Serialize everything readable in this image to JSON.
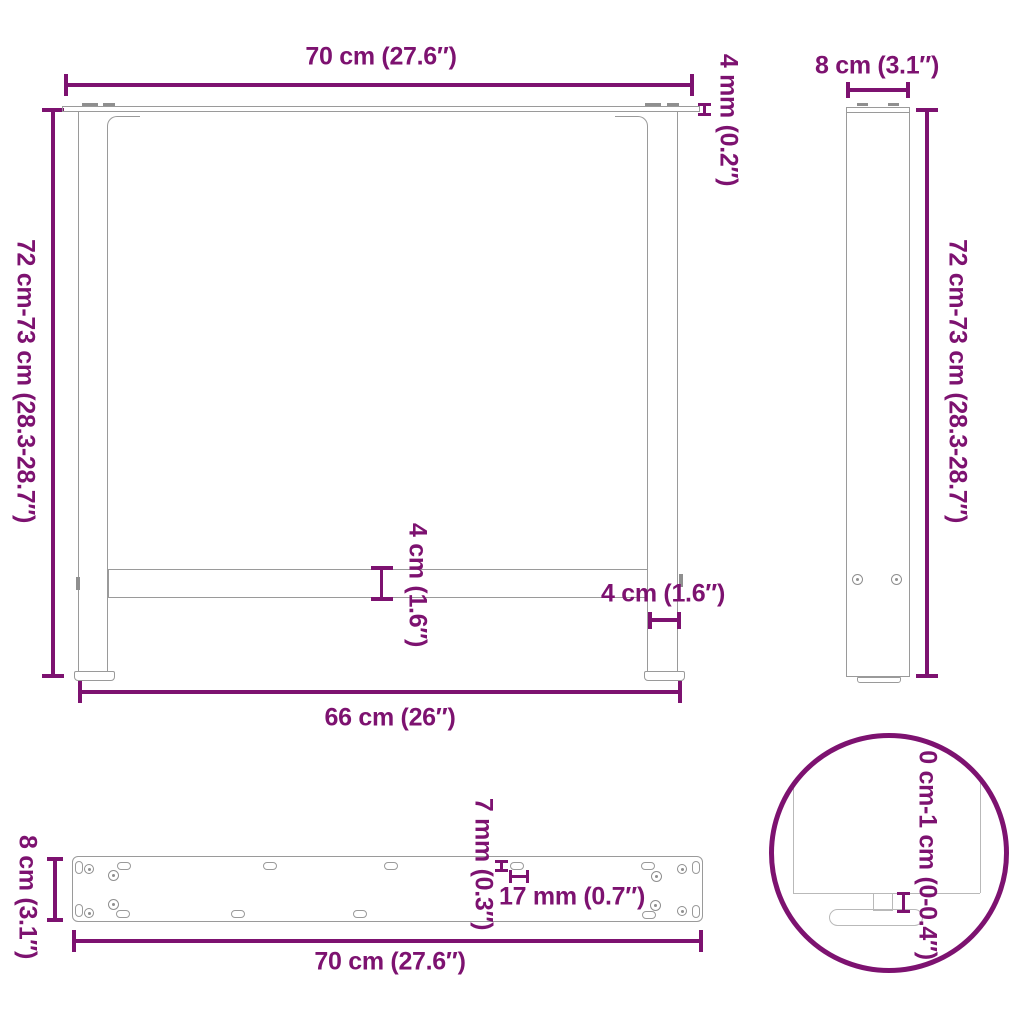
{
  "colors": {
    "accent": "#7d1270",
    "outline": "#9a9a9a"
  },
  "front_view": {
    "top_width": "70 cm (27.6″)",
    "plate_thickness": "4 mm (0.2″)",
    "height": "72 cm-73 cm (28.3-28.7″)",
    "crossbar_width": "4 cm (1.6″)",
    "leg_width": "4 cm (1.6″)",
    "bottom_width": "66 cm (26″)"
  },
  "side_view": {
    "depth": "8 cm (3.1″)",
    "height": "72 cm-73 cm (28.3-28.7″)"
  },
  "plate_view": {
    "depth": "8 cm (3.1″)",
    "hole_diameter": "7 mm (0.3″)",
    "slot_length": "17 mm (0.7″)",
    "width": "70 cm (27.6″)"
  },
  "detail_view": {
    "foot_adjustment": "0 cm-1 cm (0-0.4″)"
  }
}
